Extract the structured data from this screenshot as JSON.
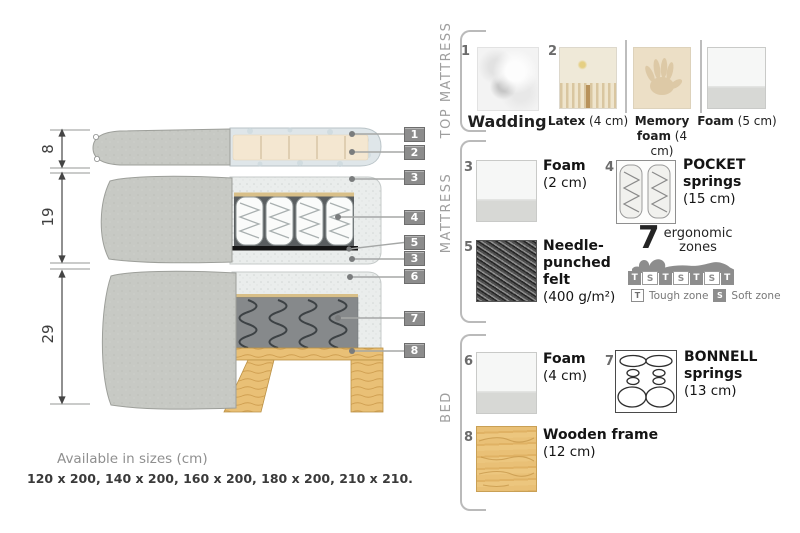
{
  "diagram": {
    "dim_top": "8",
    "dim_mid": "19",
    "dim_bottom": "29",
    "callouts": [
      "1",
      "2",
      "3",
      "4",
      "5",
      "3",
      "6",
      "7",
      "8"
    ],
    "sizes_title": "Available in sizes (cm)",
    "sizes_values": "120 x 200, 140 x 200, 160 x 200, 180 x 200, 210 x 210."
  },
  "legend": {
    "sections": {
      "top_mattress": {
        "label": "TOP MATTRESS",
        "wadding": {
          "num": "1",
          "name": "Wadding"
        },
        "latex": {
          "num": "2",
          "name": "Latex",
          "size": "(4 cm)"
        },
        "memory": {
          "name": "Memory foam",
          "size": "(4 cm)"
        },
        "foam5": {
          "name": "Foam",
          "size": "(5 cm)"
        }
      },
      "mattress": {
        "label": "MATTRESS",
        "foam2": {
          "num": "3",
          "name": "Foam",
          "size": "(2 cm)"
        },
        "pocket": {
          "num": "4",
          "name": "POCKET springs",
          "size": "(15 cm)"
        },
        "felt": {
          "num": "5",
          "name": "Needle-punched felt",
          "size": "(400 g/m²)"
        },
        "zones": {
          "count": "7",
          "line1": "ergonomic",
          "line2": "zones",
          "cells": [
            "T",
            "S",
            "T",
            "S",
            "T",
            "S",
            "T"
          ],
          "tough_key": "T",
          "tough_label": "Tough zone",
          "soft_key": "S",
          "soft_label": "Soft zone"
        }
      },
      "bed": {
        "label": "BED",
        "foam4": {
          "num": "6",
          "name": "Foam",
          "size": "(4 cm)"
        },
        "bonnell": {
          "num": "7",
          "name": "BONNELL springs",
          "size": "(13 cm)"
        },
        "frame": {
          "num": "8",
          "name": "Wooden frame",
          "size": "(12 cm)"
        }
      }
    }
  },
  "colors": {
    "fabric": "#c7c9c4",
    "wadding": "#dfe6e9",
    "latex": "#f4e7d1",
    "foam_speckle": "#eaedec",
    "felt_dark": "#151515",
    "bonnell_gray": "#86898b",
    "wood": "#e9c076",
    "badge": "#8c8c8c"
  }
}
